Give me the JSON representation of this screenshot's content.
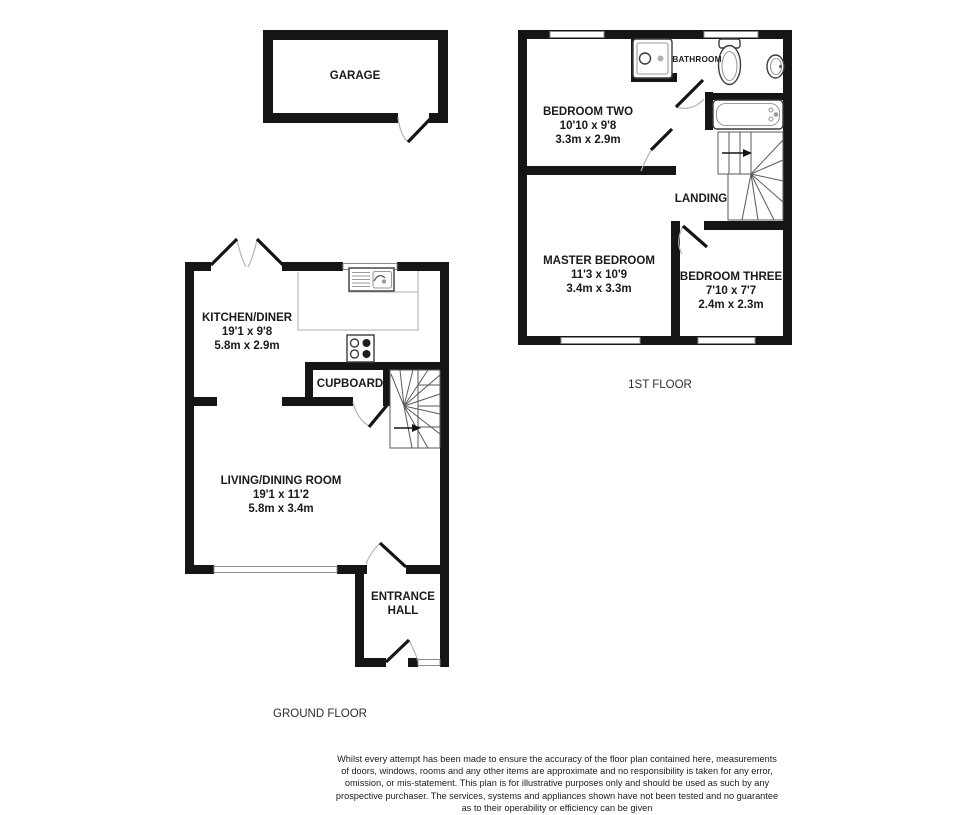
{
  "rooms": {
    "garage": {
      "name": "GARAGE"
    },
    "kitchen_diner": {
      "name": "KITCHEN/DINER",
      "imperial": "19'1 x 9'8",
      "metric": "5.8m x 2.9m"
    },
    "cupboard": {
      "name": "CUPBOARD"
    },
    "living_dining": {
      "name": "LIVING/DINING ROOM",
      "imperial": "19'1 x 11'2",
      "metric": "5.8m x 3.4m"
    },
    "entrance_hall": {
      "name": "ENTRANCE HALL"
    },
    "bedroom_two": {
      "name": "BEDROOM TWO",
      "imperial": "10'10 x 9'8",
      "metric": "3.3m x 2.9m"
    },
    "bathroom": {
      "name": "BATHROOM"
    },
    "landing": {
      "name": "LANDING"
    },
    "master_bedroom": {
      "name": "MASTER BEDROOM",
      "imperial": "11'3 x 10'9",
      "metric": "3.4m x 3.3m"
    },
    "bedroom_three": {
      "name": "BEDROOM THREE",
      "imperial": "7'10 x 7'7",
      "metric": "2.4m x 2.3m"
    }
  },
  "floors": {
    "ground": "GROUND FLOOR",
    "first": "1ST FLOOR"
  },
  "fixture_icons": [
    "shower-icon",
    "toilet-icon",
    "sink-icon",
    "bathtub-icon",
    "kitchen-sink-icon",
    "hob-icon",
    "staircase-icon",
    "stairs-direction-arrow-icon"
  ],
  "disclaimer_lines": [
    "Whilst every attempt has been made to ensure the accuracy of the floor plan contained here, measurements",
    "of doors, windows, rooms and any other items are approximate and no responsibility is taken for any error,",
    "omission, or mis-statement. This plan is for illustrative purposes only and should be used as such by any",
    "prospective purchaser. The services, systems and appliances shown have not been tested and no guarantee",
    "as to their operability or efficiency can be given"
  ],
  "colors": {
    "wall": "#151515",
    "door_arc": "#b3b3b3",
    "fixture_outline": "#3c3c3c",
    "counter_outline": "#bdbdbd",
    "background": "#ffffff"
  }
}
